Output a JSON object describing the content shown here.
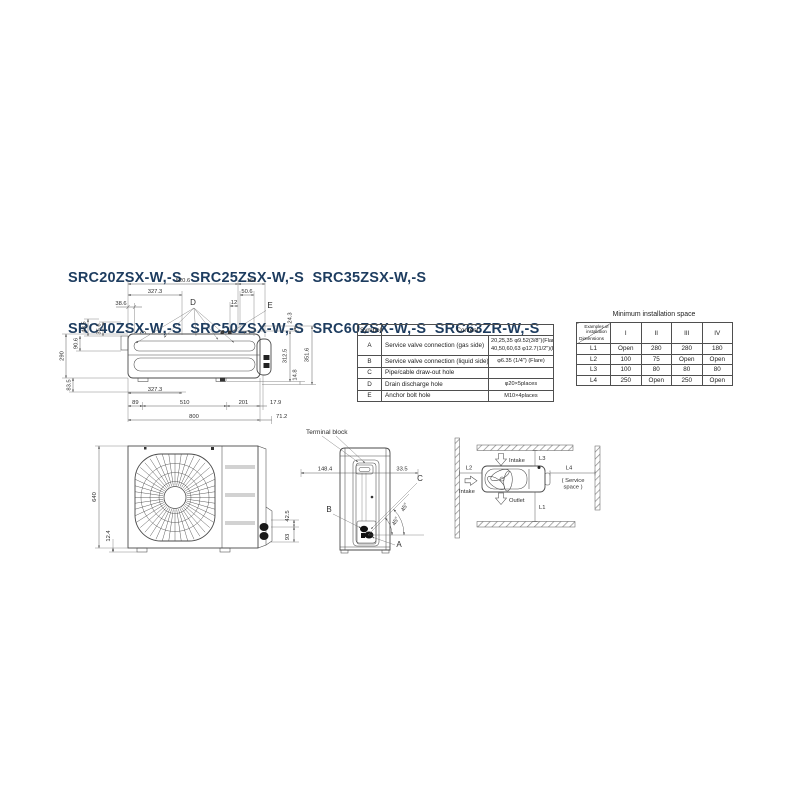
{
  "title": {
    "line1": "SRC20ZSX-W,-S  SRC25ZSX-W,-S  SRC35ZSX-W,-S",
    "line2": "SRC40ZSX-W,-S  SRC50ZSX-W,-S  SRC60ZSX-W,-S  SRC63ZR-W,-S"
  },
  "colors": {
    "title": "#1d3c5f",
    "line": "#4a4a4a"
  },
  "top_view": {
    "labels": {
      "d": "D",
      "e": "E"
    },
    "dims": {
      "d520": "520.6",
      "d161": "161",
      "d327t": "327.3",
      "d50": "50.6",
      "d12": "12",
      "d38": "38.6",
      "d43": "43.5",
      "d35": "35.6",
      "d90": "90.6",
      "d290": "290",
      "d24": "24.3",
      "d312": "312.5",
      "d351": "351.6",
      "d14": "14.8",
      "d83": "83.5",
      "d327b": "327.3",
      "d89": "89",
      "d510": "510",
      "d201": "201",
      "d17": "17.9",
      "d800": "800",
      "d71": "71.2"
    }
  },
  "symbol_table": {
    "header_symbol": "Symbol",
    "header_content": "Content",
    "rows": [
      {
        "symbol": "A",
        "desc": "Service valve connection (gas side)",
        "val1": "20,25,35 φ9.52(3/8\")(Flare)",
        "val2": "40,50,60,63 φ12.7(1/2\")(Flare)"
      },
      {
        "symbol": "B",
        "desc": "Service valve connection (liquid side)",
        "val1": "φ6.35 (1/4\")  (Flare)",
        "val2": ""
      },
      {
        "symbol": "C",
        "desc": "Pipe/cable draw-out hole",
        "val1": "",
        "val2": ""
      },
      {
        "symbol": "D",
        "desc": "Drain discharge hole",
        "val1": "φ20×5places",
        "val2": ""
      },
      {
        "symbol": "E",
        "desc": "Anchor bolt hole",
        "val1": "M10×4places",
        "val2": ""
      }
    ]
  },
  "installation_table": {
    "title": "Minimum installation space",
    "corner_top": "Examples of installation",
    "corner_bottom": "Dimensions",
    "columns": [
      "I",
      "II",
      "III",
      "IV"
    ],
    "rows": [
      {
        "label": "L1",
        "values": [
          "Open",
          "280",
          "280",
          "180"
        ]
      },
      {
        "label": "L2",
        "values": [
          "100",
          "75",
          "Open",
          "Open"
        ]
      },
      {
        "label": "L3",
        "values": [
          "100",
          "80",
          "80",
          "80"
        ]
      },
      {
        "label": "L4",
        "values": [
          "250",
          "Open",
          "250",
          "Open"
        ]
      }
    ]
  },
  "front_view": {
    "dims": {
      "height": "640",
      "foot": "12.4",
      "pipe_upper": "42.5",
      "pipe_lower": "93"
    }
  },
  "side_view": {
    "terminal_block": "Terminal block",
    "labels": {
      "a": "A",
      "b": "B",
      "c": "C"
    },
    "dims": {
      "d148": "148.4",
      "d33": "33.5",
      "angle1": "45°",
      "angle2": "45°"
    }
  },
  "space_diagram": {
    "labels": {
      "l1": "L1",
      "l2": "L2",
      "l3": "L3",
      "l4": "L4",
      "intake_top": "Intake",
      "intake_left": "Intake",
      "outlet": "Outlet",
      "service1": "( Service",
      "service2": "space )"
    }
  }
}
